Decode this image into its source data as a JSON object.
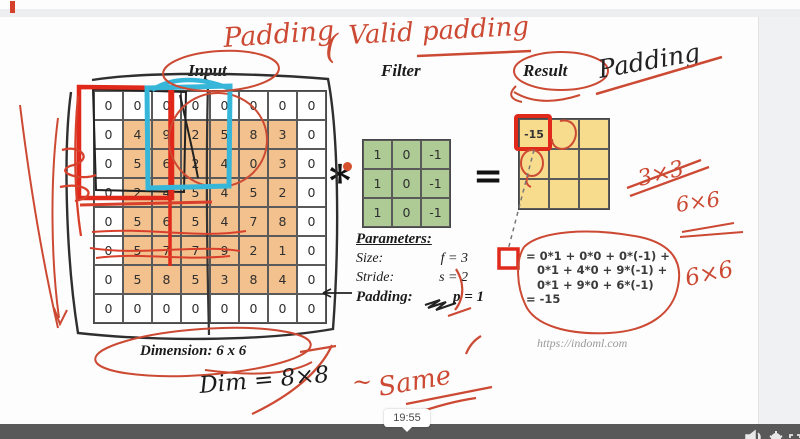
{
  "video": {
    "timestamp_tooltip": "19:55"
  },
  "slide": {
    "headers": {
      "input": "Input",
      "filter": "Filter",
      "result": "Result"
    },
    "operators": {
      "convolve": "*",
      "equals": "="
    },
    "input_grid": {
      "rows": [
        [
          0,
          0,
          0,
          0,
          0,
          0,
          0,
          0
        ],
        [
          0,
          4,
          9,
          2,
          5,
          8,
          3,
          0
        ],
        [
          0,
          5,
          6,
          2,
          4,
          0,
          3,
          0
        ],
        [
          0,
          2,
          4,
          5,
          4,
          5,
          2,
          0
        ],
        [
          0,
          5,
          6,
          5,
          4,
          7,
          8,
          0
        ],
        [
          0,
          5,
          7,
          7,
          9,
          2,
          1,
          0
        ],
        [
          0,
          5,
          8,
          5,
          3,
          8,
          4,
          0
        ],
        [
          0,
          0,
          0,
          0,
          0,
          0,
          0,
          0
        ]
      ],
      "dimension_label": "Dimension: 6 x 6"
    },
    "filter_grid": {
      "rows": [
        [
          1,
          0,
          -1
        ],
        [
          1,
          0,
          -1
        ],
        [
          1,
          0,
          -1
        ]
      ]
    },
    "result_grid": {
      "rows": [
        [
          "-15",
          "",
          ""
        ],
        [
          "",
          "",
          ""
        ],
        [
          "",
          "",
          ""
        ]
      ]
    },
    "parameters": {
      "title": "Parameters:",
      "size_label": "Size:",
      "size_value": "f = 3",
      "stride_label": "Stride:",
      "stride_value": "s = 2",
      "padding_label": "Padding:",
      "padding_value": "p = 1"
    },
    "computation": {
      "line1": "= 0*1 + 0*0 + 0*(-1) +",
      "line2": "0*1 + 4*0 + 9*(-1) +",
      "line3": "0*1 + 9*0 + 6*(-1)",
      "line4": "= -15"
    },
    "watermark": "https://indoml.com"
  },
  "annotations": {
    "padding_word": "Padding",
    "brace": "(",
    "valid_padding": "Valid padding",
    "padding_black": "Padding",
    "crossed_3x3": "3×3",
    "six_by_six_1": "6×6",
    "six_by_six_2": "6×6",
    "tilde": "~",
    "same": "Same",
    "dim_8x8": "Dim = 8×8"
  },
  "colors": {
    "input_cell": "#f3c18d",
    "filter_cell": "#aeca95",
    "result_cell": "#f8dc8e",
    "marker_red": "#cc4a33",
    "marker_thick_red": "#e03020",
    "marker_cyan": "#36b6d9",
    "player_bar": "#595959"
  }
}
